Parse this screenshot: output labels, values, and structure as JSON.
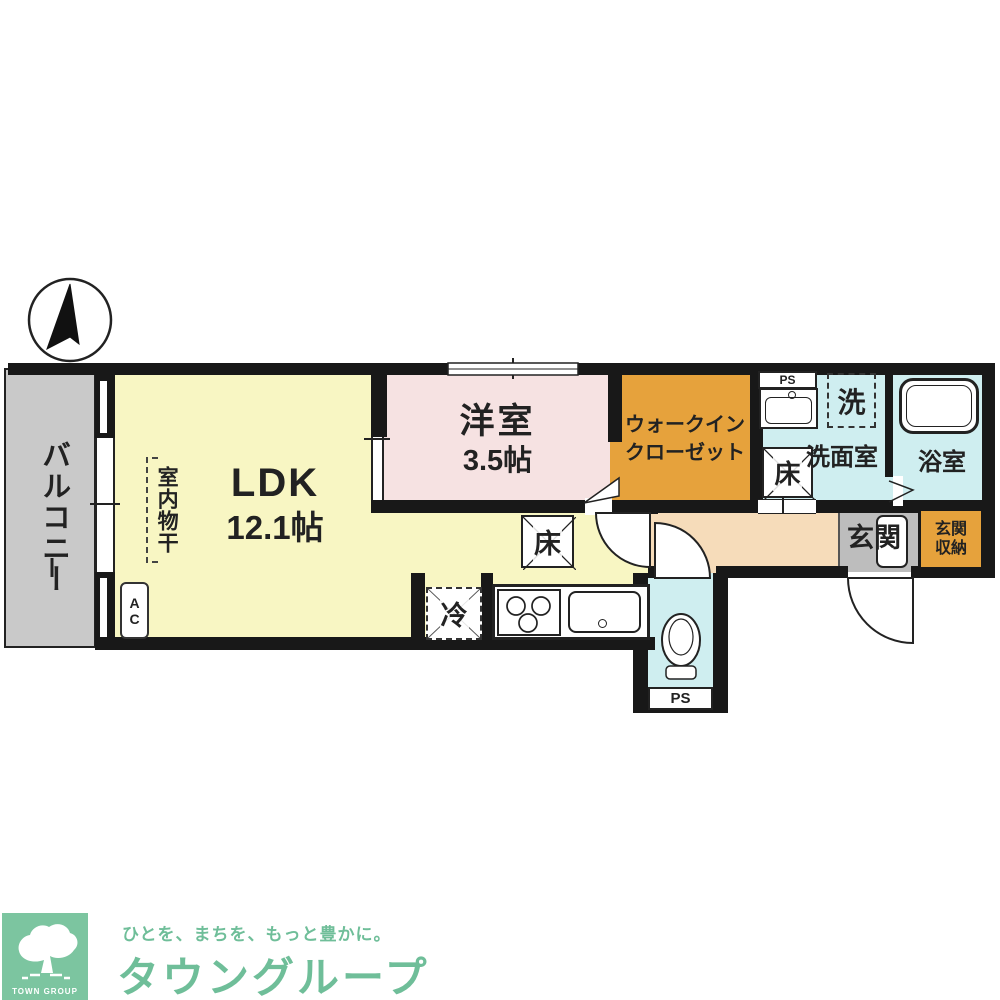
{
  "plan": {
    "rooms": {
      "balcony": "バルコニー",
      "ldk_name": "LDK",
      "ldk_size": "12.1帖",
      "bedroom_name": "洋室",
      "bedroom_size": "3.5帖",
      "wic_line1": "ウォークイン",
      "wic_line2": "クローゼット",
      "washroom": "洗面室",
      "bathroom": "浴室",
      "entrance": "玄関",
      "entrance_storage_line1": "玄関",
      "entrance_storage_line2": "収納"
    },
    "fixtures": {
      "indoor_drying": "室内物干",
      "washer": "洗",
      "fridge": "冷",
      "floor_hatch": "床",
      "ac_unit": "AC",
      "pipe_space": "PS"
    },
    "colors": {
      "ldk": "#f8f6c3",
      "bedroom": "#f6e2e2",
      "closet": "#e6a23c",
      "wet_area": "#cfeef0",
      "hallway": "#f6dcba",
      "balcony": "#c9c9c9",
      "entrance": "#bdbdbd",
      "wall": "#181818"
    }
  },
  "logo": {
    "badge": "TOWN GROUP",
    "tagline": "ひとを、まちを、もっと豊かに。",
    "brand": "タウングループ",
    "green": "#6fbe99"
  }
}
